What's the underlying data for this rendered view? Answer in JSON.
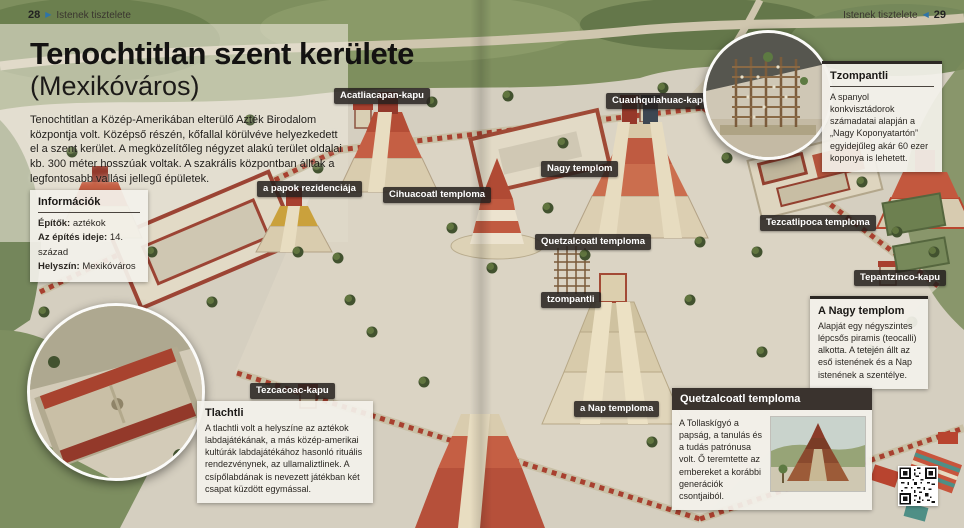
{
  "colors": {
    "accent_blue": "#2e74a8",
    "chip_bg": "#24201d",
    "callout_dark_header": "#3a332e",
    "wall_red": "#a8402f"
  },
  "folio": {
    "left_page_number": "28",
    "left_section": "Istenek tisztelete",
    "right_section": "Istenek tisztelete",
    "right_page_number": "29"
  },
  "title_block": {
    "title": "Tenochtitlan szent kerülete",
    "subtitle": "(Mexikóváros)",
    "intro": "Tenochtitlan a Közép-Amerikában elterülő Azték Birodalom központja volt. Középső részén, kőfallal körülvéve helyezkedett el a szent kerület. A megközelítőleg négyzet alakú terület oldalai kb. 300 méter hosszúak voltak. A szakrális központban álltak a legfontosabb vallási jellegű épületek."
  },
  "info_box": {
    "title": "Információk",
    "rows": [
      {
        "label": "Építők:",
        "value": "aztékok"
      },
      {
        "label": "Az építés ideje:",
        "value": "14. század"
      },
      {
        "label": "Helyszín:",
        "value": "Mexikóváros"
      }
    ]
  },
  "map_labels": [
    {
      "id": "acatliacapan-kapu",
      "text": "Acatliacapan-kapu"
    },
    {
      "id": "cuauhquiahuac-kapu",
      "text": "Cuauhquiahuac-kapu"
    },
    {
      "id": "nagy-templom",
      "text": "Nagy templom"
    },
    {
      "id": "papok-rezidenciaja",
      "text": "a papok rezidenciája"
    },
    {
      "id": "cihuacoatl-temploma",
      "text": "Cihuacoatl temploma"
    },
    {
      "id": "quetzalcoatl-temploma",
      "text": "Quetzalcoatl temploma"
    },
    {
      "id": "tezcatlipoca-temploma",
      "text": "Tezcatlipoca temploma"
    },
    {
      "id": "tepantzinco-kapu",
      "text": "Tepantzinco-kapu"
    },
    {
      "id": "tzompantli",
      "text": "tzompantli"
    },
    {
      "id": "tezcacoac-kapu",
      "text": "Tezcacoac-kapu"
    },
    {
      "id": "nap-temploma",
      "text": "a Nap temploma"
    }
  ],
  "callouts": {
    "tzompantli": {
      "title": "Tzompantli",
      "body": "A spanyol konkvisztádorok számadatai alapján a „Nagy Koponyatartón” egyidejűleg akár 60 ezer koponya is lehetett."
    },
    "nagy_templom": {
      "title": "A Nagy templom",
      "body": "Alapját egy négyszintes lépcsős piramis (teocalli) alkotta. A tetején állt az eső istenének és a Nap istenének a szentélye."
    },
    "quetzalcoatl": {
      "title": "Quetzalcoatl temploma",
      "body": "A Tollaskígyó a papság, a tanulás és a tudás patrónusa volt. Ő teremtette az embereket a korábbi generációk csontjaiból."
    },
    "tlachtli": {
      "title": "Tlachtli",
      "body": "A tlachtli volt a helyszíne az aztékok labdajátékának, a más közép-amerikai kultúrák labdajátékához hasonló rituális rendezvénynek, az ullamaliztlinek. A csípőlabdának is nevezett játékban két csapat küzdött egymással."
    }
  }
}
